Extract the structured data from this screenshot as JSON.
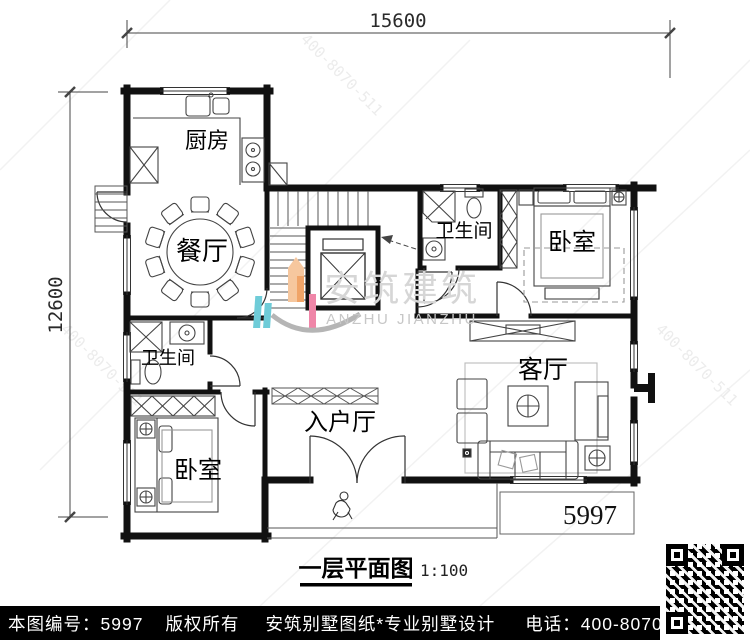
{
  "plan": {
    "dim_width": "15600",
    "dim_height": "12600",
    "number": "5997",
    "rooms": {
      "kitchen": "厨房",
      "dining": "餐厅",
      "bath_top": "卫生间",
      "bath_bottom": "卫生间",
      "bedroom_top": "卧室",
      "bedroom_bottom": "卧室",
      "living": "客厅",
      "entry": "入户厅"
    }
  },
  "watermark": {
    "cn": "安筑建筑",
    "en": "ANZHU JIANZHU",
    "phone": "400-8070-511"
  },
  "title": {
    "name": "一层平面图",
    "scale": "1:100"
  },
  "footer": {
    "sheet_no": "本图编号：5997",
    "copyright": "版权所有",
    "brand": "安筑别墅图纸*专业别墅设计",
    "phone": "电话：400-8070-511",
    "qr_hint": "扫码看图"
  },
  "colors": {
    "logo_orange": "#f0a468",
    "logo_orange_light": "#f6c79e",
    "logo_cyan": "#6fccd8",
    "logo_pink": "#ef86a8",
    "watermark_text": "#d6d6d6",
    "footer_bg": "#000000",
    "footer_text": "#ffffff"
  }
}
